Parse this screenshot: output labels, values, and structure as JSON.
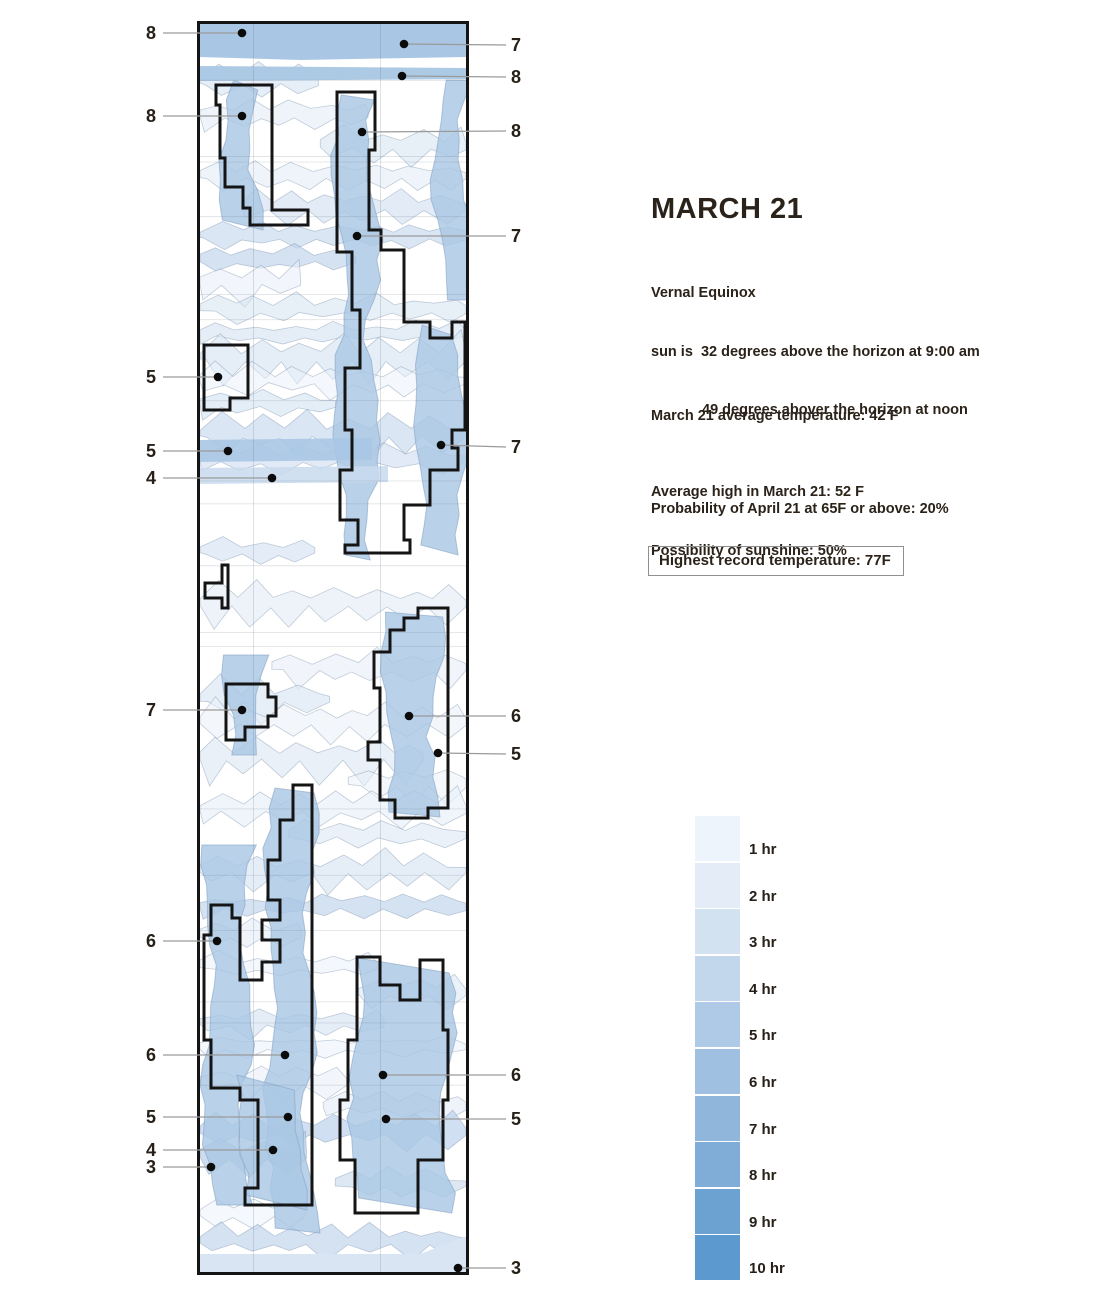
{
  "title": "MARCH 21",
  "subtitle": {
    "line1": "Vernal Equinox",
    "line2": "sun is  32 degrees above the horizon at 9:00 am",
    "line3": "49 degrees abover the horizon at noon"
  },
  "stats": {
    "avg_temp": "March 21 average temperature: 42 F",
    "avg_high": "Average high in March 21: 52 F",
    "sunshine": "Possibility of sunshine: 50%",
    "probability": "Probability of April 21 at 65F or above: 20%",
    "record": "Highest record temperature: 77F"
  },
  "legend": {
    "items": [
      {
        "label": "1 hr",
        "color": "#eef4fb"
      },
      {
        "label": "2 hr",
        "color": "#e4edf7"
      },
      {
        "label": "3 hr",
        "color": "#d3e2f1"
      },
      {
        "label": "4 hr",
        "color": "#c2d6ec"
      },
      {
        "label": "5 hr",
        "color": "#afcae6"
      },
      {
        "label": "6 hr",
        "color": "#9fc0e1"
      },
      {
        "label": "7 hr",
        "color": "#90b6dc"
      },
      {
        "label": "8 hr",
        "color": "#7fadd8"
      },
      {
        "label": "9 hr",
        "color": "#6ba2d2"
      },
      {
        "label": "10 hr",
        "color": "#5c99ce"
      }
    ]
  },
  "callouts": {
    "left": [
      {
        "label": "8",
        "y": 33,
        "dot": [
          242,
          33
        ]
      },
      {
        "label": "8",
        "y": 116,
        "dot": [
          242,
          116
        ]
      },
      {
        "label": "5",
        "y": 377,
        "dot": [
          218,
          377
        ]
      },
      {
        "label": "5",
        "y": 451,
        "dot": [
          228,
          451
        ]
      },
      {
        "label": "4",
        "y": 478,
        "dot": [
          272,
          478
        ]
      },
      {
        "label": "7",
        "y": 710,
        "dot": [
          242,
          710
        ]
      },
      {
        "label": "6",
        "y": 941,
        "dot": [
          217,
          941
        ]
      },
      {
        "label": "6",
        "y": 1055,
        "dot": [
          285,
          1055
        ]
      },
      {
        "label": "5",
        "y": 1117,
        "dot": [
          288,
          1117
        ]
      },
      {
        "label": "4",
        "y": 1150,
        "dot": [
          273,
          1150
        ]
      },
      {
        "label": "3",
        "y": 1167,
        "dot": [
          211,
          1167
        ]
      }
    ],
    "right": [
      {
        "label": "7",
        "y": 45,
        "dot": [
          404,
          44
        ]
      },
      {
        "label": "8",
        "y": 77,
        "dot": [
          402,
          76
        ]
      },
      {
        "label": "8",
        "y": 131,
        "dot": [
          362,
          132
        ]
      },
      {
        "label": "7",
        "y": 236,
        "dot": [
          357,
          236
        ]
      },
      {
        "label": "7",
        "y": 447,
        "dot": [
          441,
          445
        ]
      },
      {
        "label": "6",
        "y": 716,
        "dot": [
          409,
          716
        ]
      },
      {
        "label": "5",
        "y": 754,
        "dot": [
          438,
          753
        ]
      },
      {
        "label": "6",
        "y": 1075,
        "dot": [
          383,
          1075
        ]
      },
      {
        "label": "5",
        "y": 1119,
        "dot": [
          386,
          1119
        ]
      },
      {
        "label": "3",
        "y": 1268,
        "dot": [
          458,
          1268
        ]
      }
    ]
  },
  "colors": {
    "ink": "#262019",
    "outline": "#141414",
    "callout_line": "#9a9a9a",
    "blob": "#a9c7e4",
    "band_solid": "#a9c7e4",
    "band_bottom": "#d9e5f3"
  },
  "chart_data": {
    "type": "heatmap",
    "title": "MARCH 21",
    "units": "hours of sunshine per location on March 21",
    "scale_labels": [
      "1 hr",
      "2 hr",
      "3 hr",
      "4 hr",
      "5 hr",
      "6 hr",
      "7 hr",
      "8 hr",
      "9 hr",
      "10 hr"
    ],
    "scale_colors": [
      "#eef4fb",
      "#e4edf7",
      "#d3e2f1",
      "#c2d6ec",
      "#afcae6",
      "#9fc0e1",
      "#90b6dc",
      "#7fadd8",
      "#6ba2d2",
      "#5c99ce"
    ],
    "annotated_values_left_top_to_bottom": [
      8,
      8,
      5,
      5,
      4,
      7,
      6,
      6,
      5,
      4,
      3
    ],
    "annotated_values_right_top_to_bottom": [
      7,
      8,
      8,
      7,
      7,
      6,
      5,
      6,
      5,
      3
    ],
    "legend_position": "bottom-right",
    "notes": "Vertical strip map with contour regions of sunshine hours; bold black stepped outlines mark labeled zones."
  }
}
